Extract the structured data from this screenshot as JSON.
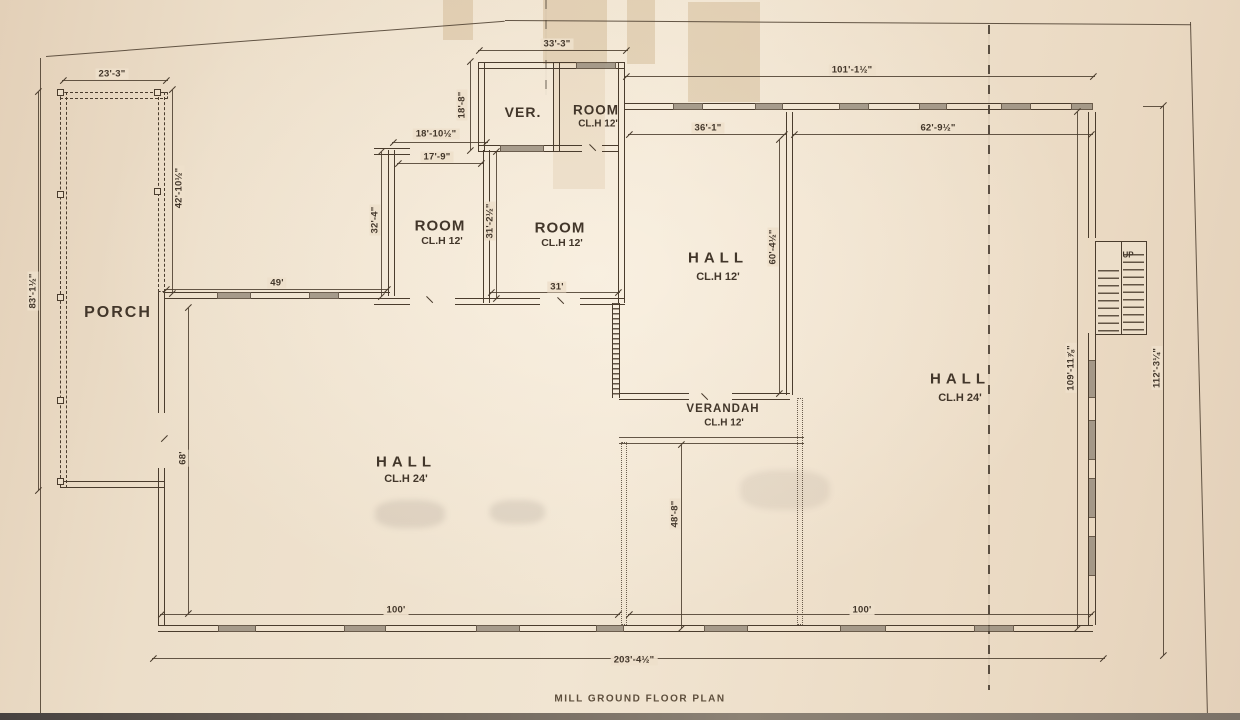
{
  "title_block": {
    "title": "MILL GROUND FLOOR PLAN"
  },
  "rooms": {
    "porch": {
      "label": "PORCH"
    },
    "ver": {
      "label": "VER."
    },
    "room_top": {
      "label": "ROOM",
      "ceiling": "CL.H 12'"
    },
    "room_left": {
      "label": "ROOM",
      "ceiling": "CL.H 12'"
    },
    "room_center": {
      "label": "ROOM",
      "ceiling": "CL.H 12'"
    },
    "hall_center": {
      "label": "HALL",
      "ceiling": "CL.H 12'"
    },
    "hall_left": {
      "label": "HALL",
      "ceiling": "CL.H 24'"
    },
    "hall_right": {
      "label": "HALL",
      "ceiling": "CL.H 24'"
    },
    "verandah": {
      "label": "VERANDAH",
      "ceiling": "CL.H 12'"
    },
    "stairs": {
      "label": "UP"
    }
  },
  "dimensions": {
    "porch_width": "23'-3\"",
    "porch_total_height": "83'-1½\"",
    "porch_upper_height": "42'-10½\"",
    "ver_block_width": "33'-3\"",
    "ver_height": "18'-8\"",
    "room_left_outer_width": "18'-10½\"",
    "room_left_width": "17'-9\"",
    "room_left_height": "32'-4\"",
    "room_center_height": "31'-2½\"",
    "room_center_width": "31'",
    "left_wing_width": "49'",
    "north_range_width": "101'-1½\"",
    "hall_center_width": "36'-1\"",
    "hall_right_width": "62'-9½\"",
    "hall_center_height": "60'-4½\"",
    "hall_left_height": "68'",
    "verandah_passage_height": "48'-8\"",
    "south_left_width": "100'",
    "south_right_width": "100'",
    "overall_width": "203'-4½\"",
    "east_inner_height": "109'-11⅞\"",
    "east_outer_height": "112'-3¼\""
  },
  "colors": {
    "paper": "#ecdec9",
    "ink": "#4a3c2d",
    "window_fill": "#94897a"
  }
}
